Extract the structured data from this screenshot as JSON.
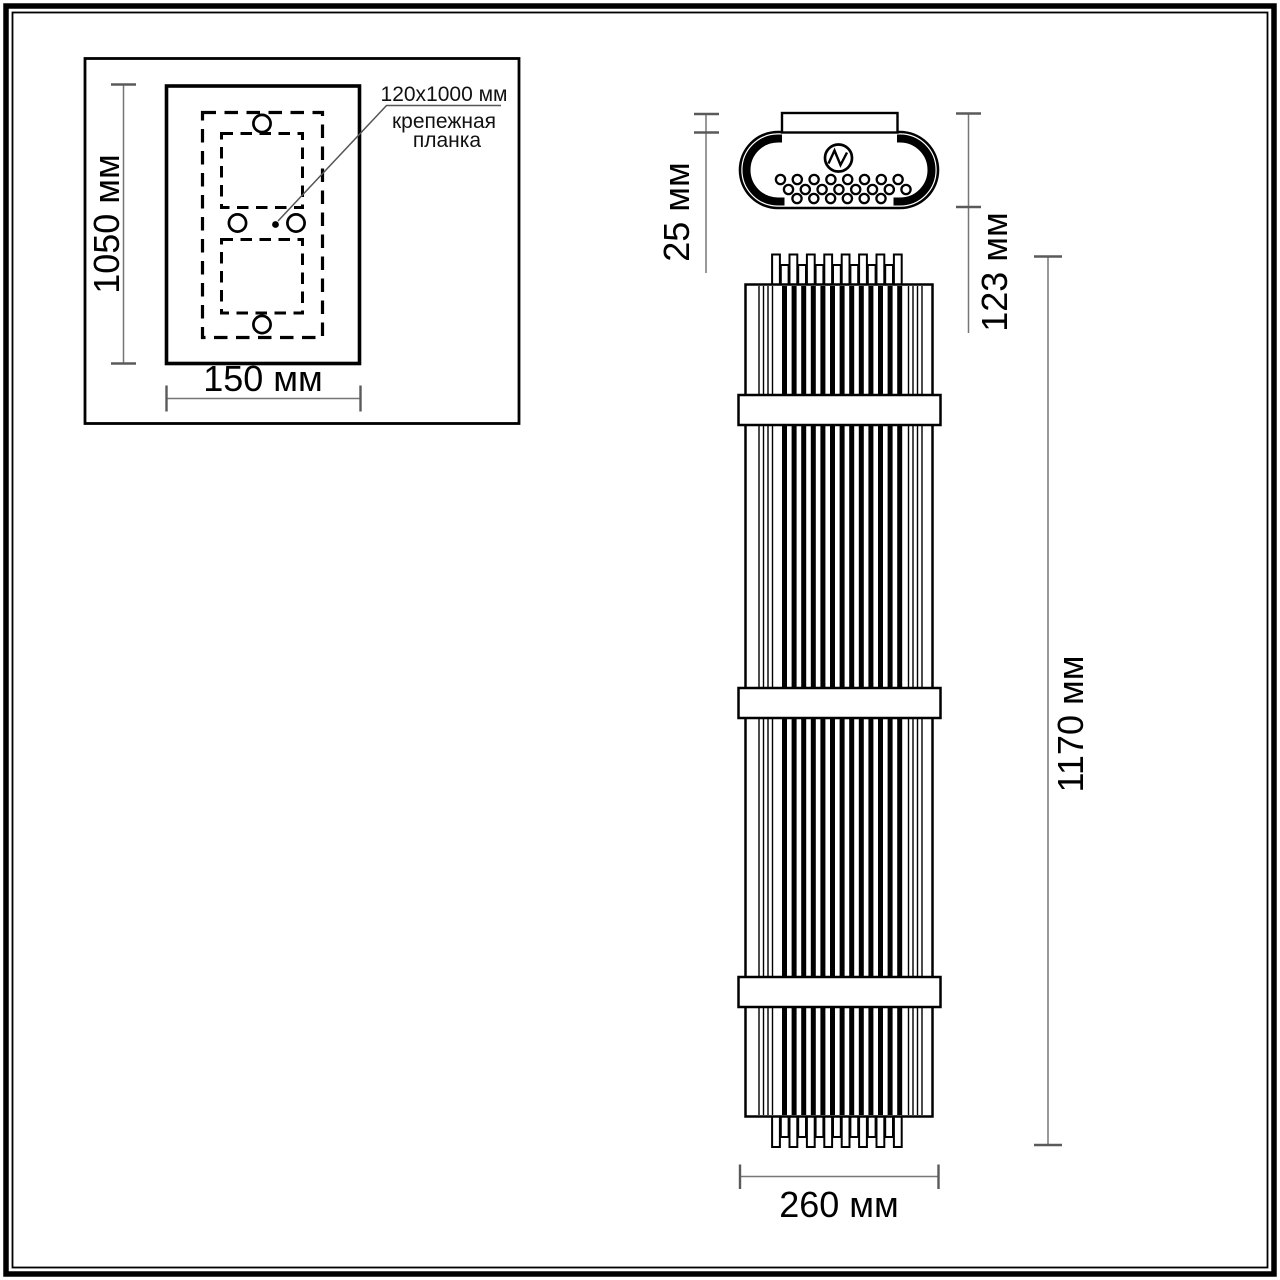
{
  "drawing": {
    "inset": {
      "height_label": "1050 мм",
      "width_label": "150 мм",
      "callout_size": "120x1000 мм",
      "callout_name_line1": "крепежная",
      "callout_name_line2": "планка"
    },
    "top_view": {
      "plate_thickness_label": "25 мм",
      "depth_label": "123 мм"
    },
    "front_view": {
      "height_label": "1170 мм",
      "width_label": "260 мм"
    }
  },
  "colors": {
    "ink": "#000000",
    "dim_line": "#767676",
    "background": "#ffffff"
  }
}
